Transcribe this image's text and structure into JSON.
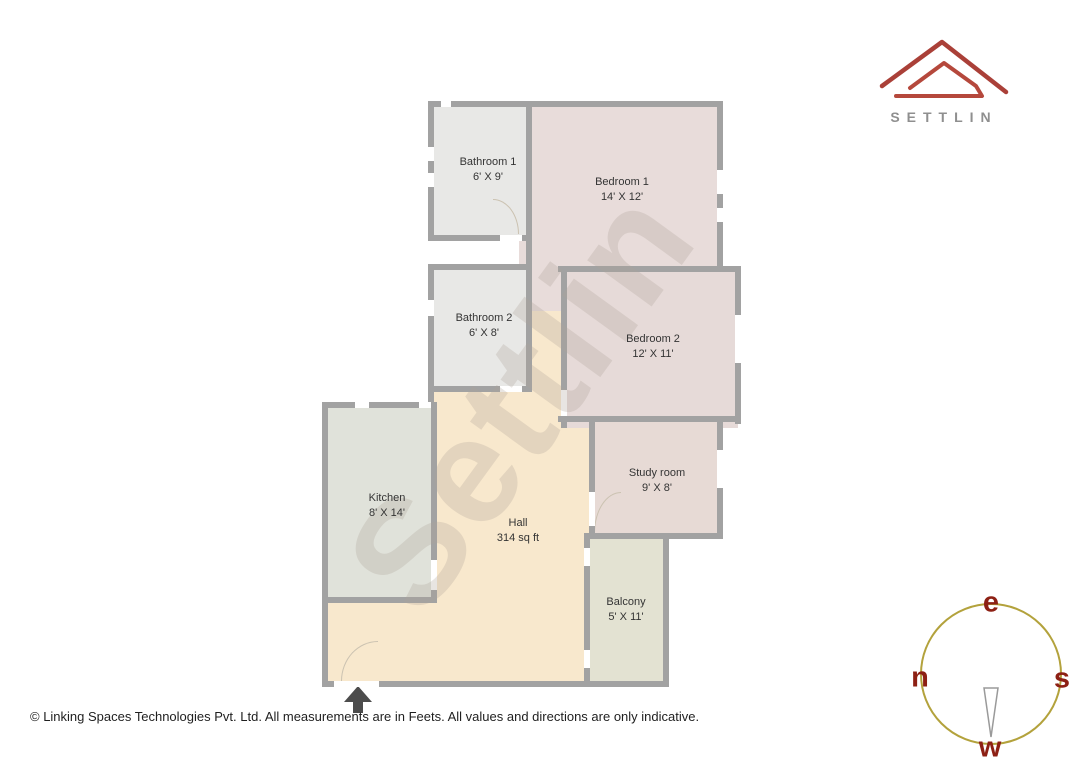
{
  "brand": {
    "name": "SETTLIN"
  },
  "plan": {
    "watermark": "Settlin",
    "rooms": {
      "bathroom1": {
        "name": "Bathroom 1",
        "dims": "6' X 9'"
      },
      "bedroom1": {
        "name": "Bedroom 1",
        "dims": "14' X 12'"
      },
      "bathroom2": {
        "name": "Bathroom 2",
        "dims": "6' X 8'"
      },
      "bedroom2": {
        "name": "Bedroom 2",
        "dims": "12' X 11'"
      },
      "studyroom": {
        "name": "Study room",
        "dims": "9' X 8'"
      },
      "kitchen": {
        "name": "Kitchen",
        "dims": "8' X 14'"
      },
      "hall": {
        "name": "Hall",
        "dims": "314 sq ft"
      },
      "balcony": {
        "name": "Balcony",
        "dims": "5' X 11'"
      }
    }
  },
  "compass": {
    "top": "e",
    "left": "n",
    "right": "s",
    "bottom": "w"
  },
  "footer": {
    "text": "© Linking Spaces Technologies Pvt. Ltd. All measurements are in Feets. All values and directions are only indicative."
  },
  "colors": {
    "wall": "#a2a2a2",
    "hall_floor": "#f8e8cd",
    "bedroom_floor": "#e8dcda",
    "bathroom_floor": "#e8e8e6",
    "kitchen_floor": "#e0e2da",
    "balcony_floor": "#e3e2d2",
    "logo_red": "#aa4038",
    "compass_circle": "#b3a23c",
    "compass_letters": "#8d2014"
  }
}
